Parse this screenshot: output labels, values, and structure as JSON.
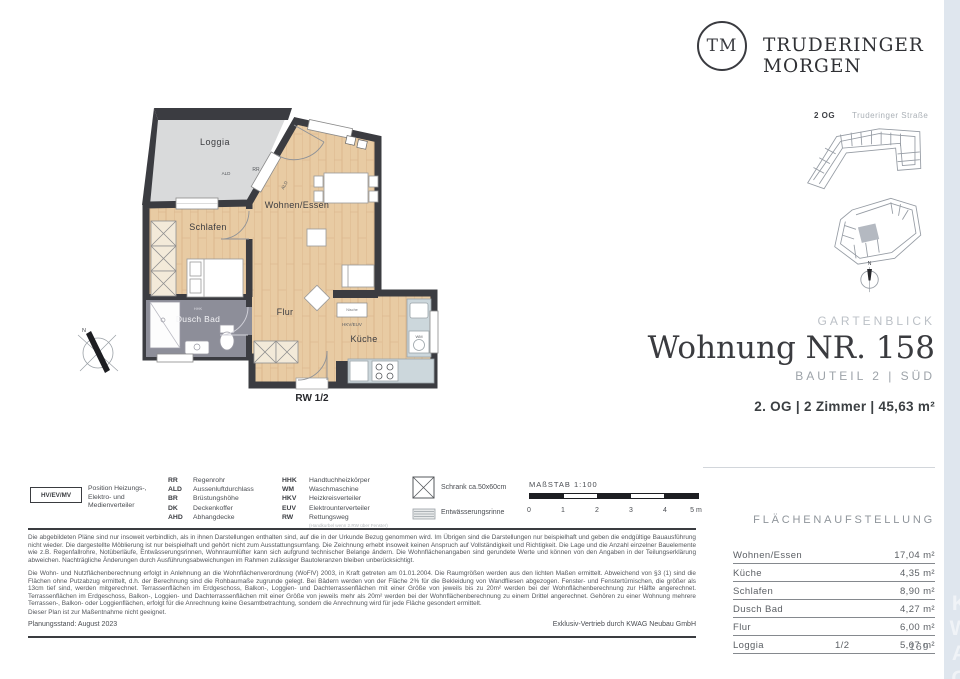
{
  "brand": {
    "logo_initials": "TM",
    "name": "TRUDERINGER MORGEN"
  },
  "site_plan": {
    "floor_label": "2 OG",
    "street_label": "Truderinger Straße",
    "compass_label": "N"
  },
  "title_block": {
    "project": "GARTENBLICK",
    "title": "Wohnung NR. 158",
    "subtitle": "BAUTEIL 2 | SÜD",
    "details": "2. OG | 2 Zimmer | 45,63 m²"
  },
  "floor_plan": {
    "labels": {
      "loggia": "Loggia",
      "wohnen": "Wohnen/Essen",
      "schlafen": "Schlafen",
      "flur": "Flur",
      "bad": "Dusch Bad",
      "kueche": "Küche",
      "rr": "RR",
      "ald": "ALD",
      "ald2": "ALD",
      "hhk": "HHK",
      "nische": "Nische",
      "hkv": "HKV/EUV",
      "wm": "WM",
      "rw": "RW 1/2",
      "compass": "N"
    }
  },
  "legend": {
    "distribution_box": {
      "code": "HV/EV/MV",
      "label": "Position Heizungs-, Elektro- und Medienverteiler"
    },
    "abbr_col1": [
      {
        "code": "RR",
        "label": "Regenrohr"
      },
      {
        "code": "ALD",
        "label": "Aussenluftdurchlass"
      },
      {
        "code": "BR",
        "label": "Brüstungshöhe"
      },
      {
        "code": "DK",
        "label": "Deckenkoffer"
      },
      {
        "code": "AHD",
        "label": "Abhangdecke"
      }
    ],
    "abbr_col2": [
      {
        "code": "HHK",
        "label": "Handtuchheizkörper"
      },
      {
        "code": "WM",
        "label": "Waschmaschine"
      },
      {
        "code": "HKV",
        "label": "Heizkreisverteiler"
      },
      {
        "code": "EUV",
        "label": "Elektrounterverteiler"
      },
      {
        "code": "RW",
        "label": "Rettungsweg",
        "note": "(Handkurbel wenn 2.RW über Fenster)"
      }
    ],
    "symbols": [
      {
        "label": "Schrank ca.50x60cm"
      },
      {
        "label": "Entwässerungsrinne"
      }
    ],
    "scale": {
      "label": "MAßSTAB 1:100",
      "ticks": [
        "0",
        "1",
        "2",
        "3",
        "4",
        "5 m"
      ]
    }
  },
  "area_table": {
    "heading": "FLÄCHENAUFSTELLUNG",
    "rows": [
      {
        "label": "Wohnen/Essen",
        "share": "",
        "value": "17,04 m²"
      },
      {
        "label": "Küche",
        "share": "",
        "value": "4,35 m²"
      },
      {
        "label": "Schlafen",
        "share": "",
        "value": "8,90 m²"
      },
      {
        "label": "Dusch Bad",
        "share": "",
        "value": "4,27 m²"
      },
      {
        "label": "Flur",
        "share": "",
        "value": "6,00 m²"
      },
      {
        "label": "Loggia",
        "share": "1/2",
        "value": "5,07 m²"
      }
    ]
  },
  "disclaimer": {
    "p1": "Die abgebildeten Pläne sind nur insoweit verbindlich, als in ihnen Darstellungen enthalten sind, auf die in der Urkunde Bezug genommen wird. Im Übrigen sind die Darstellungen nur beispielhaft und geben die endgültige Bauausführung nicht wieder. Die dargestellte Möblierung ist nur beispielhaft und gehört nicht zum Ausstattungsumfang. Die Zeichnung erhebt insoweit keinen Anspruch auf Vollständigkeit und Richtigkeit. Die Lage und die Anzahl einzelner Bauelemente wie z.B. Regenfallrohre, Notüberläufe, Entwässerungsrinnen, Wohnraumlüfter kann sich aufgrund technischer Belange ändern. Die Wohnflächenangaben sind gerundete Werte und können von den Angaben in der Teilungserklärung abweichen. Nachträgliche Änderungen durch Ausführungsabweichungen im Rahmen zulässiger Bautoleranzen bleiben unberücksichtigt.",
    "p2": "Die Wohn- und Nutzflächenberechnung erfolgt in Anlehnung an die Wohnflächenverordnung (WoFlV) 2003, in Kraft getreten am 01.01.2004. Die Raumgrößen werden aus den lichten Maßen ermittelt. Abweichend von §3 (1) sind die Flächen ohne Putzabzug ermittelt, d.h. der Berechnung sind die Rohbaumaße zugrunde gelegt. Bei Bädern werden von der Fläche 2% für die Bekleidung von Wandfliesen abgezogen. Fenster- und Fenstertürnischen, die größer als 13cm tief sind, werden mitgerechnet. Terrassenflächen im Erdgeschoss, Balkon-, Loggien- und Dachterrassenflächen mit einer Größe von jeweils bis zu 20m² werden bei der Wohnflächenberechnung zur Hälfte angerechnet. Terrassenflächen im Erdgeschoss, Balkon-, Loggien- und Dachterrassenflächen mit einer Größe von jeweils mehr als 20m² werden bei der Wohnflächenberechnung zu einem Drittel angerechnet. Gehören zu einer Wohnung mehrere Terrassen-, Balkon- oder Loggienflächen, erfolgt für die Anrechnung keine Gesamtbetrachtung, sondern die Anrechnung wird für jede Fläche gesondert ermittelt.",
    "p3": "Dieser Plan ist zur Maßentnahme nicht geeignet."
  },
  "footer": {
    "left": "Planungsstand: August 2023",
    "right": "Exklusiv-Vertrieb durch KWAG Neubau GmbH",
    "page_number": "169",
    "watermark": "KWAG"
  },
  "colors": {
    "wall": "#3b3c41",
    "wood": "#e8cba3",
    "loggia": "#d9dadb",
    "bath": "#8d8e99",
    "counter": "#ccd7dc",
    "edge": "#dfe6ee"
  }
}
